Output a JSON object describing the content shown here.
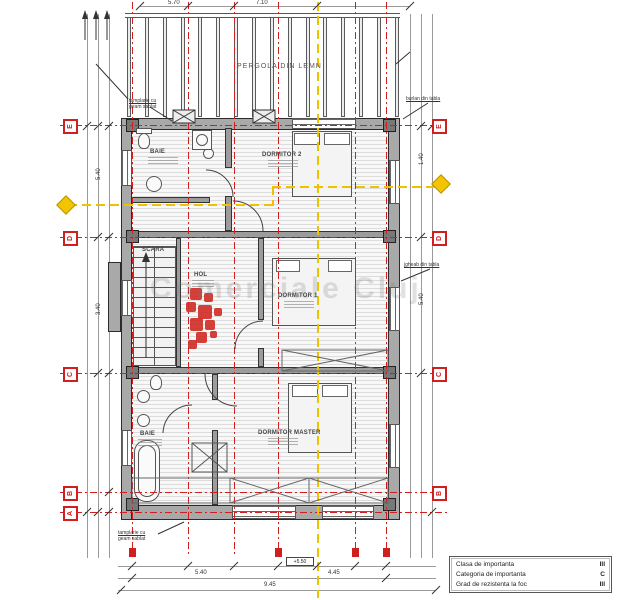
{
  "colors": {
    "grid_red": "#d01f1f",
    "section_yellow": "#eec200",
    "wall_gray": "#a9a9a9",
    "logo_red": "#cf2b24",
    "watermark_gray": "#787878"
  },
  "pergola": {
    "label": "PERGOLA DIN LEMN"
  },
  "rooms": {
    "baie_top": "BAIE",
    "dormitor2": "DORMITOR 2",
    "scara": "SCARA",
    "hol": "HOL",
    "dormitor1": "DORMITOR 1",
    "baie_bottom": "BAIE",
    "master": "DORMITOR MASTER"
  },
  "annotations": {
    "top_left_line1": "tamplarie cu",
    "top_left_line2": "geam sablat",
    "top_right": "burlan din tabla",
    "right_mid": "jgheab din tabla",
    "bottom_left_line1": "tamplarie cu",
    "bottom_left_line2": "geam sablat"
  },
  "grid": {
    "left_labels": [
      "E",
      "D",
      "C",
      "B",
      "A"
    ],
    "right_labels": [
      "E",
      "D",
      "C",
      "B",
      "A"
    ]
  },
  "dimensions": {
    "top": [
      "5.70",
      "7.10"
    ],
    "left": [
      "5.40",
      "3.40"
    ],
    "right": [
      "1.40",
      "5.40"
    ],
    "bottom": [
      "5.40",
      "4.45",
      "9.45"
    ]
  },
  "elevation_marker": "+5.50",
  "watermark": "Comerciale Cluj",
  "legend": {
    "rows": [
      {
        "label": "Clasa de importanta",
        "value": "III"
      },
      {
        "label": "Categoria de importanta",
        "value": "C"
      },
      {
        "label": "Grad de rezistenta la foc",
        "value": "III"
      }
    ]
  }
}
